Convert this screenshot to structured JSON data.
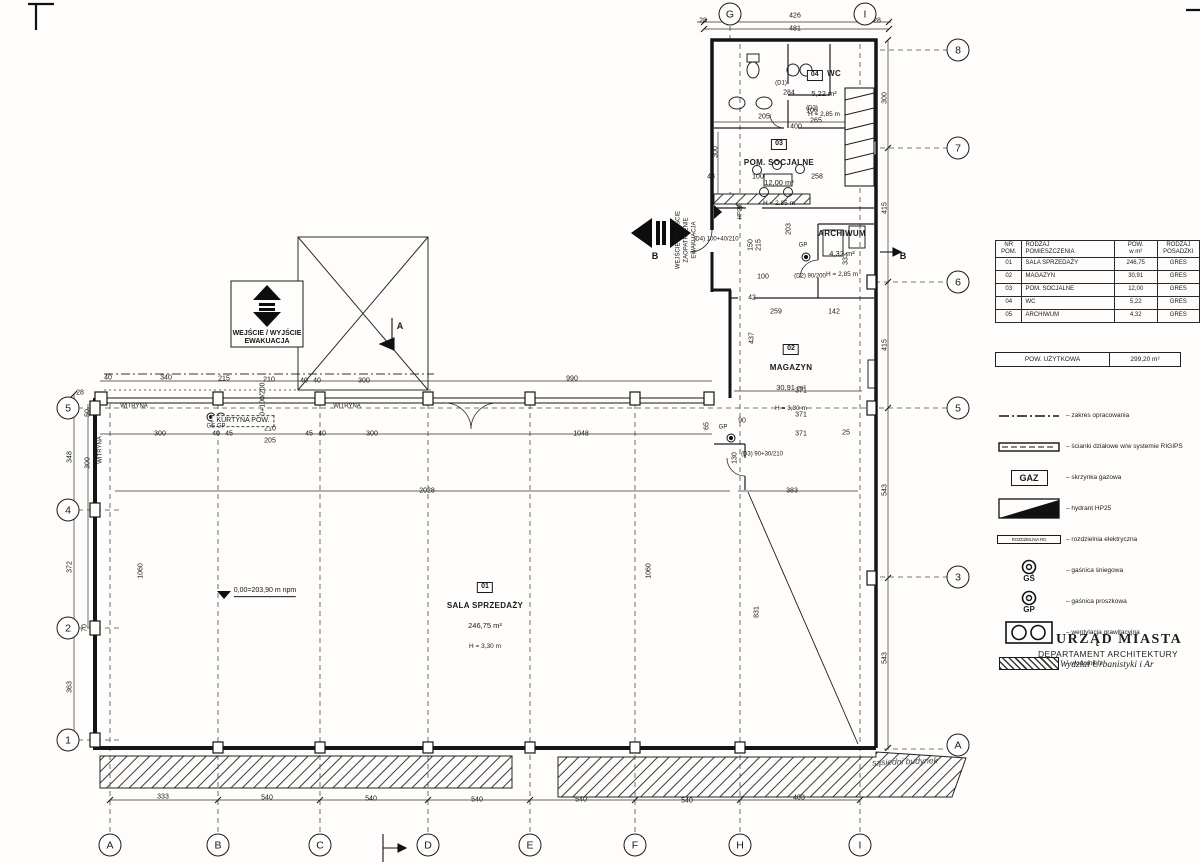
{
  "stamp": {
    "line1": "URZĄD MIASTA",
    "line2": "DEPARTAMENT ARCHITEKTURY",
    "line3": "Wydział Urbanistyki i Ar"
  },
  "schedule_table": {
    "headers": [
      {
        "t": "NR",
        "b": "POM."
      },
      {
        "t": "RODZAJ",
        "b": "POMIESZCZENIA"
      },
      {
        "t": "POW.",
        "b": "w m²"
      },
      {
        "t": "RODZAJ",
        "b": "POSADZKI"
      }
    ],
    "rows": [
      [
        "01",
        "SALA SPRZEDAŻY",
        "246,75",
        "GRES"
      ],
      [
        "02",
        "MAGAZYN",
        "30,91",
        "GRES"
      ],
      [
        "03",
        "POM. SOCJALNE",
        "12,00",
        "GRES"
      ],
      [
        "04",
        "WC",
        "5,22",
        "GRES"
      ],
      [
        "05",
        "ARCHIWUM",
        "4,32",
        "GRES"
      ]
    ],
    "summary": {
      "label": "POW. UŻYTKOWA",
      "value": "299,20  m²"
    }
  },
  "legend": {
    "items": [
      {
        "icon": "boundary-line",
        "label": "zakres opracowania"
      },
      {
        "icon": "partition-wall",
        "label": "ścianki działowe w/w systemie RIGIPS"
      },
      {
        "icon": "gas-box",
        "symbol_text": "GAZ",
        "label": "skrzynka gazowa"
      },
      {
        "icon": "hydrant",
        "label": "hydrant HP25"
      },
      {
        "icon": "electrical-board",
        "symbol_text": "ROZDZIELNIA RG",
        "label": "rozdzielnia elektryczna"
      },
      {
        "icon": "snow-extinguisher",
        "symbol_text": "GŚ",
        "label": "gaśnica śniegowa"
      },
      {
        "icon": "powder-extinguisher",
        "symbol_text": "GP",
        "label": "gaśnica proszkowa"
      },
      {
        "icon": "gravity-vent",
        "label": "wentylacja grawitacyjna"
      },
      {
        "icon": "water-meter",
        "label": "wodomierz"
      }
    ]
  },
  "rooms": [
    {
      "number": "01",
      "name": "SALA SPRZEDAŻY",
      "area": "246,75 m²",
      "height": "H = 3,30 m",
      "x": 485,
      "y": 574
    },
    {
      "number": "02",
      "name": "MAGAZYN",
      "area": "30,91 m²",
      "height": "H = 3,30 m",
      "x": 791,
      "y": 336
    },
    {
      "number": "03",
      "name": "POM. SOCJALNE",
      "area": "12,00 m²",
      "height": "H = 2,85 m",
      "x": 779,
      "y": 131
    },
    {
      "number": "04",
      "name": "WC",
      "area": "5,22 m²",
      "height": "H = 2,85 m",
      "x": 824,
      "y": 62
    },
    {
      "number": "",
      "name": "ARCHIWUM",
      "area": "4,32 m²",
      "height": "H = 2,85 m",
      "x": 842,
      "y": 222
    }
  ],
  "axes": {
    "bottom": [
      {
        "l": "A",
        "x": 110
      },
      {
        "l": "B",
        "x": 218
      },
      {
        "l": "C",
        "x": 320
      },
      {
        "l": "D",
        "x": 428
      },
      {
        "l": "E",
        "x": 530
      },
      {
        "l": "F",
        "x": 635
      },
      {
        "l": "H",
        "x": 740
      },
      {
        "l": "I",
        "x": 860
      }
    ],
    "bottom_y": 845,
    "top": [
      {
        "l": "G",
        "x": 730
      },
      {
        "l": "I",
        "x": 865
      }
    ],
    "top_y": 14,
    "left": [
      {
        "l": "5",
        "y": 408
      },
      {
        "l": "4",
        "y": 510
      },
      {
        "l": "2",
        "y": 628
      },
      {
        "l": "1",
        "y": 740
      }
    ],
    "left_x": 68,
    "right": [
      {
        "l": "8",
        "y": 50
      },
      {
        "l": "7",
        "y": 148
      },
      {
        "l": "6",
        "y": 282
      },
      {
        "l": "5",
        "y": 408
      },
      {
        "l": "3",
        "y": 577
      },
      {
        "l": "A",
        "y": 745
      }
    ],
    "right_x": 958
  },
  "dimensions": [
    [
      "28",
      703,
      21
    ],
    [
      "426",
      795,
      16
    ],
    [
      "481",
      795,
      29
    ],
    [
      "28",
      877,
      21
    ],
    [
      "284",
      789,
      93
    ],
    [
      "205",
      764,
      117
    ],
    [
      "106",
      812,
      111
    ],
    [
      "400",
      796,
      127
    ],
    [
      "265",
      816,
      121
    ],
    [
      "300",
      716,
      152,
      1
    ],
    [
      "43",
      711,
      177
    ],
    [
      "100",
      758,
      177
    ],
    [
      "258",
      817,
      177
    ],
    [
      "203",
      789,
      229,
      1
    ],
    [
      "150",
      751,
      245,
      1
    ],
    [
      "215",
      759,
      245,
      1
    ],
    [
      "333",
      846,
      259,
      1
    ],
    [
      "100",
      763,
      277
    ],
    [
      "42",
      752,
      298
    ],
    [
      "300",
      885,
      98,
      1
    ],
    [
      "415",
      885,
      208,
      1
    ],
    [
      "415",
      885,
      345,
      1
    ],
    [
      "543",
      885,
      490,
      1
    ],
    [
      "543",
      885,
      658,
      1
    ],
    [
      "259",
      776,
      312
    ],
    [
      "142",
      834,
      312
    ],
    [
      "437",
      752,
      338,
      1
    ],
    [
      "371",
      801,
      391
    ],
    [
      "371",
      801,
      415
    ],
    [
      "371",
      801,
      434
    ],
    [
      "383",
      792,
      491
    ],
    [
      "130",
      735,
      458,
      1
    ],
    [
      "65",
      707,
      426,
      1
    ],
    [
      "90",
      742,
      421
    ],
    [
      "25",
      846,
      433
    ],
    [
      "40",
      108,
      378
    ],
    [
      "340",
      166,
      378
    ],
    [
      "215",
      224,
      379
    ],
    [
      "210",
      269,
      380
    ],
    [
      "40",
      304,
      381
    ],
    [
      "40",
      317,
      381
    ],
    [
      "300",
      364,
      381
    ],
    [
      "990",
      572,
      379
    ],
    [
      "300",
      160,
      434
    ],
    [
      "40",
      216,
      434
    ],
    [
      "45",
      229,
      434
    ],
    [
      "210",
      270,
      429
    ],
    [
      "205",
      270,
      441
    ],
    [
      "45",
      309,
      434
    ],
    [
      "40",
      322,
      434
    ],
    [
      "300",
      372,
      434
    ],
    [
      "1048",
      581,
      434
    ],
    [
      "100+100/200",
      263,
      403,
      1
    ],
    [
      "2028",
      427,
      491
    ],
    [
      "1060",
      649,
      571,
      1
    ],
    [
      "831",
      757,
      612,
      1
    ],
    [
      "1060",
      141,
      571,
      1
    ],
    [
      "28",
      80,
      393
    ],
    [
      "50",
      88,
      413,
      1
    ],
    [
      "348",
      70,
      457,
      1
    ],
    [
      "300",
      88,
      463,
      1
    ],
    [
      "372",
      70,
      567,
      1
    ],
    [
      "70",
      85,
      628,
      1
    ],
    [
      "363",
      70,
      687,
      1
    ],
    [
      "333",
      163,
      797
    ],
    [
      "540",
      267,
      798
    ],
    [
      "540",
      371,
      799
    ],
    [
      "540",
      477,
      800
    ],
    [
      "540",
      581,
      800
    ],
    [
      "540",
      687,
      801
    ],
    [
      "403",
      799,
      798
    ]
  ],
  "annotations": [
    {
      "n": "evac-entrance-label",
      "t": "WEJŚCIE / WYJŚCIE",
      "x": 267,
      "y": 334,
      "c": "t7 b"
    },
    {
      "n": "evac-entrance-label",
      "t": "EWAKUACJA",
      "x": 267,
      "y": 342,
      "c": "t7 b"
    },
    {
      "n": "supply-entrance-label",
      "t": "WEJŚCIE / WYJŚCIE",
      "x": 679,
      "y": 240,
      "c": "t6 rot"
    },
    {
      "n": "supply-entrance-label",
      "t": "ZAOPATRZENIE",
      "x": 687,
      "y": 240,
      "c": "t6 rot"
    },
    {
      "n": "supply-entrance-label",
      "t": "EWAKUACJA",
      "x": 695,
      "y": 240,
      "c": "t6 rot"
    },
    {
      "n": "section-b-label",
      "t": "B",
      "x": 655,
      "y": 257,
      "c": "t9 b"
    },
    {
      "n": "section-b-label",
      "t": "B",
      "x": 903,
      "y": 257,
      "c": "t9 b"
    },
    {
      "n": "section-a-label",
      "t": "A",
      "x": 400,
      "y": 327,
      "c": "t9 b"
    },
    {
      "n": "curtain-label",
      "t": "KURTYNA POW.",
      "x": 243,
      "y": 421,
      "c": "t7 dashbox"
    },
    {
      "n": "shopwindow-label",
      "t": "WITRYNA",
      "x": 134,
      "y": 407,
      "c": "t6"
    },
    {
      "n": "shopwindow-label",
      "t": "WITRYNA",
      "x": 347,
      "y": 407,
      "c": "t6"
    },
    {
      "n": "shopwindow-label",
      "t": "WITRYNA",
      "x": 101,
      "y": 450,
      "c": "t6 rot"
    },
    {
      "n": "extinguisher-label",
      "t": "GŚ GP",
      "x": 216,
      "y": 427,
      "c": "t6"
    },
    {
      "n": "extinguisher-label",
      "t": "GP",
      "x": 723,
      "y": 428,
      "c": "t6"
    },
    {
      "n": "extinguisher-label",
      "t": "GP",
      "x": 803,
      "y": 246,
      "c": "t6"
    },
    {
      "n": "hydrant-label",
      "t": "HP25",
      "x": 741,
      "y": 212,
      "c": "t6 rot"
    },
    {
      "n": "level-label",
      "t": "0,00=203,90 m npm",
      "x": 265,
      "y": 592,
      "c": "t7 u"
    },
    {
      "n": "door-tag",
      "t": "(D1)",
      "x": 781,
      "y": 84,
      "c": "t6"
    },
    {
      "n": "door-tag",
      "t": "(D2)",
      "x": 812,
      "y": 109,
      "c": "t6"
    },
    {
      "n": "door-tag",
      "t": "(D2) 90/200",
      "x": 810,
      "y": 277,
      "c": "t6"
    },
    {
      "n": "door-tag",
      "t": "(D3) 90+30/210",
      "x": 762,
      "y": 455,
      "c": "t6"
    },
    {
      "n": "door-tag",
      "t": "(D4) 100+40/210",
      "x": 716,
      "y": 240,
      "c": "t6"
    },
    {
      "n": "neighbor-building-label",
      "t": "sąsiedni budynek",
      "x": 905,
      "y": 762,
      "c": "hand"
    }
  ]
}
